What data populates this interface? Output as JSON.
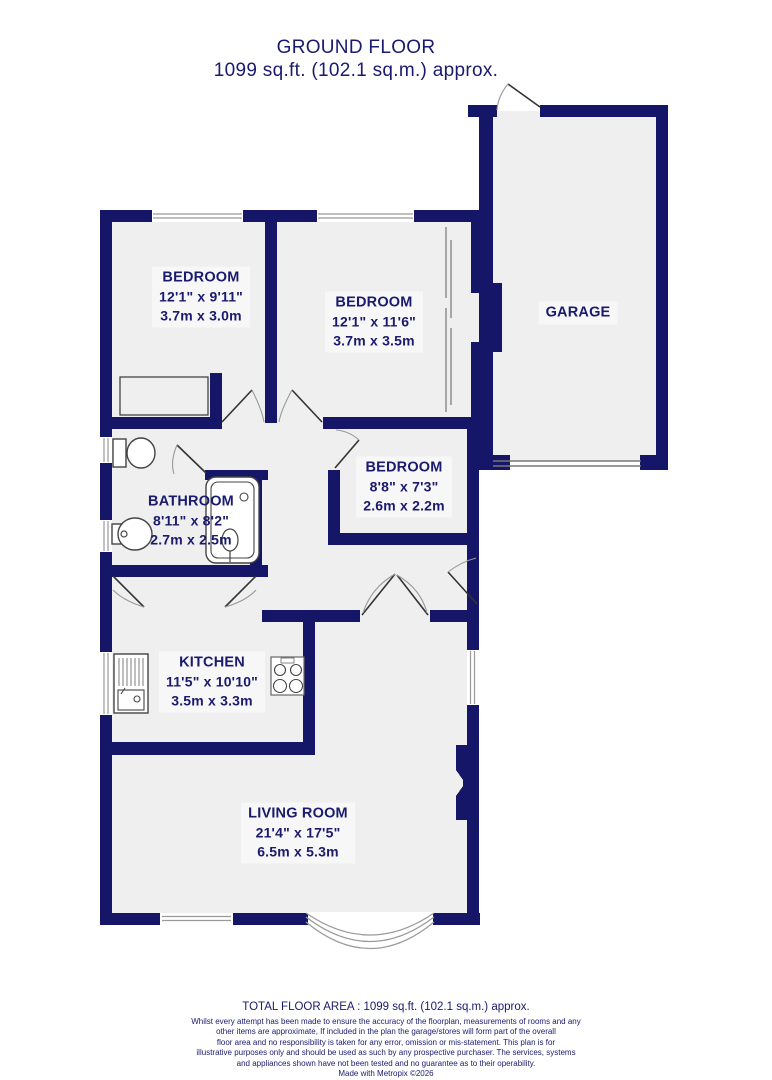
{
  "title": {
    "line1": "GROUND FLOOR",
    "line2": "1099 sq.ft. (102.1 sq.m.) approx."
  },
  "rooms": {
    "bedroom1": {
      "name": "BEDROOM",
      "imperial": "12'1\"  x 9'11\"",
      "metric": "3.7m  x 3.0m"
    },
    "bedroom2": {
      "name": "BEDROOM",
      "imperial": "12'1\"  x 11'6\"",
      "metric": "3.7m  x 3.5m"
    },
    "bedroom3": {
      "name": "BEDROOM",
      "imperial": "8'8\"  x 7'3\"",
      "metric": "2.6m  x 2.2m"
    },
    "bathroom": {
      "name": "BATHROOM",
      "imperial": "8'11\"  x 8'2\"",
      "metric": "2.7m  x 2.5m"
    },
    "kitchen": {
      "name": "KITCHEN",
      "imperial": "11'5\"  x 10'10\"",
      "metric": "3.5m  x 3.3m"
    },
    "living": {
      "name": "LIVING ROOM",
      "imperial": "21'4\"  x 17'5\"",
      "metric": "6.5m  x 5.3m"
    },
    "garage": {
      "name": "GARAGE"
    }
  },
  "footer": {
    "total": "TOTAL FLOOR AREA : 1099 sq.ft. (102.1 sq.m.) approx.",
    "disclaimer_lines": [
      "Whilst every attempt has been made to ensure the accuracy of the floorplan, measurements of rooms and any",
      "other items are approximate, If included in the plan the garage/stores will form part of the overall",
      "floor area and no responsibility is taken for any error, omission or mis-statement. This plan is for",
      "illustrative purposes only and should be used as such by any prospective purchaser. The services, systems",
      "and appliances shown have not been tested and no guarantee as to their operability."
    ],
    "credit": "Made with Metropix ©2026"
  },
  "colors": {
    "wall": "#161668",
    "text": "#1a1a6e",
    "floor": "#efefef",
    "plate": "#f7f7f7"
  }
}
